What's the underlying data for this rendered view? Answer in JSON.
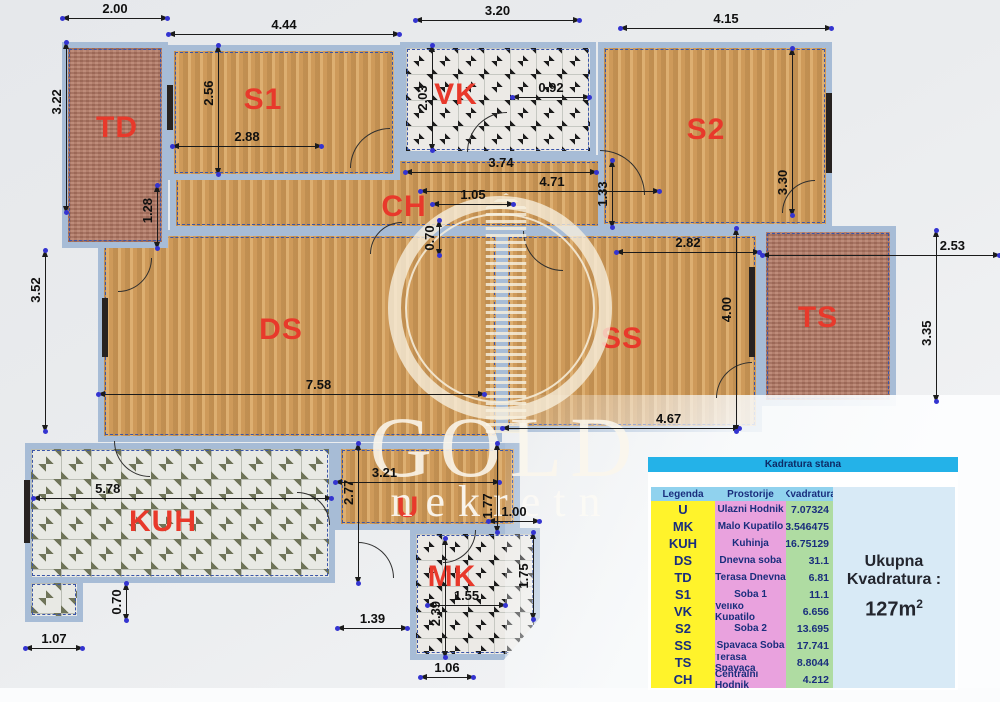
{
  "watermark": {
    "line1": "GOLD",
    "line2": "nekretn"
  },
  "plan": {
    "colors": {
      "wall": "#a7bcd6",
      "dashed_line": "#3a55a8",
      "room_label": "#e8392b",
      "dim_dot": "#3434d0",
      "dim_text": "#101010"
    },
    "rooms": [
      {
        "id": "ch",
        "label": "CH",
        "x": 170,
        "y": 155,
        "w": 442,
        "h": 77,
        "tex": "wood",
        "lx": 404,
        "ly": 207
      },
      {
        "id": "s1",
        "label": "S1",
        "x": 168,
        "y": 45,
        "w": 232,
        "h": 135,
        "tex": "wood",
        "lx": 263,
        "ly": 100
      },
      {
        "id": "vk",
        "label": "VK",
        "x": 400,
        "y": 42,
        "w": 196,
        "h": 115,
        "tex": "tileb",
        "lx": 456,
        "ly": 95
      },
      {
        "id": "s2",
        "label": "S2",
        "x": 598,
        "y": 42,
        "w": 234,
        "h": 188,
        "tex": "wood",
        "lx": 706,
        "ly": 130
      },
      {
        "id": "ds",
        "label": "DS",
        "x": 98,
        "y": 230,
        "w": 404,
        "h": 212,
        "tex": "wood",
        "lx": 281,
        "ly": 330
      },
      {
        "id": "ss",
        "label": "SS",
        "x": 502,
        "y": 230,
        "w": 260,
        "h": 202,
        "tex": "wood",
        "lx": 622,
        "ly": 339
      },
      {
        "id": "ts",
        "label": "TS",
        "x": 760,
        "y": 226,
        "w": 136,
        "h": 180,
        "tex": "terra",
        "lx": 818,
        "ly": 318
      },
      {
        "id": "td",
        "label": "TD",
        "x": 62,
        "y": 42,
        "w": 106,
        "h": 206,
        "tex": "terra",
        "lx": 117,
        "ly": 128
      },
      {
        "id": "kuh",
        "label": "KUH",
        "x": 25,
        "y": 443,
        "w": 310,
        "h": 140,
        "tex": "tileo",
        "lx": 163,
        "ly": 522
      },
      {
        "id": "kuh2",
        "label": "",
        "x": 25,
        "y": 577,
        "w": 58,
        "h": 45,
        "tex": "tileo",
        "lx": 0,
        "ly": 0
      },
      {
        "id": "u",
        "label": "U",
        "x": 335,
        "y": 443,
        "w": 185,
        "h": 87,
        "tex": "wood",
        "lx": 408,
        "ly": 508
      },
      {
        "id": "mk",
        "label": "MK",
        "x": 410,
        "y": 528,
        "w": 130,
        "h": 132,
        "tex": "tileb",
        "lx": 452,
        "ly": 577
      }
    ],
    "dimensions": [
      {
        "t": "2.00",
        "o": "h",
        "x": 62,
        "y": 18,
        "l": 106
      },
      {
        "t": "4.44",
        "o": "h",
        "x": 168,
        "y": 34,
        "l": 232
      },
      {
        "t": "3.20",
        "o": "h",
        "x": 415,
        "y": 20,
        "l": 165
      },
      {
        "t": "4.15",
        "o": "h",
        "x": 620,
        "y": 28,
        "l": 212
      },
      {
        "t": "2.88",
        "o": "h",
        "x": 172,
        "y": 146,
        "l": 150
      },
      {
        "t": "0.92",
        "o": "h",
        "x": 512,
        "y": 97,
        "l": 78
      },
      {
        "t": "3.74",
        "o": "h",
        "x": 405,
        "y": 172,
        "l": 192
      },
      {
        "t": "4.71",
        "o": "h",
        "x": 420,
        "y": 191,
        "l": 240,
        "lp": 0.55
      },
      {
        "t": "1.05",
        "o": "h",
        "x": 432,
        "y": 204,
        "l": 82
      },
      {
        "t": "2.82",
        "o": "h",
        "x": 616,
        "y": 252,
        "l": 144
      },
      {
        "t": "2.53",
        "o": "h",
        "x": 762,
        "y": 255,
        "l": 238,
        "lp": 0.8
      },
      {
        "t": "7.58",
        "o": "h",
        "x": 98,
        "y": 394,
        "l": 387,
        "lp": 0.57
      },
      {
        "t": "4.67",
        "o": "h",
        "x": 502,
        "y": 428,
        "l": 238,
        "lp": 0.7
      },
      {
        "t": "5.78",
        "o": "h",
        "x": 33,
        "y": 498,
        "l": 299,
        "lp": 0.25
      },
      {
        "t": "1.07",
        "o": "h",
        "x": 25,
        "y": 648,
        "l": 58
      },
      {
        "t": "3.21",
        "o": "h",
        "x": 335,
        "y": 482,
        "l": 165,
        "lp": 0.3
      },
      {
        "t": "1.00",
        "o": "h",
        "x": 488,
        "y": 521,
        "l": 52
      },
      {
        "t": "1.55",
        "o": "h",
        "x": 427,
        "y": 605,
        "l": 79
      },
      {
        "t": "1.39",
        "o": "h",
        "x": 337,
        "y": 628,
        "l": 71
      },
      {
        "t": "1.06",
        "o": "h",
        "x": 420,
        "y": 677,
        "l": 54
      },
      {
        "t": "3.22",
        "o": "v",
        "x": 66,
        "y": 42,
        "l": 171,
        "lp": 0.65
      },
      {
        "t": "3.52",
        "o": "v",
        "x": 45,
        "y": 250,
        "l": 182,
        "lp": 0.78
      },
      {
        "t": "2.56",
        "o": "v",
        "x": 218,
        "y": 45,
        "l": 130,
        "lp": 0.63
      },
      {
        "t": "1.28",
        "o": "v",
        "x": 157,
        "y": 185,
        "l": 64,
        "lp": 0.6
      },
      {
        "t": "2.03",
        "o": "v",
        "x": 432,
        "y": 45,
        "l": 106
      },
      {
        "t": "1.33",
        "o": "v",
        "x": 612,
        "y": 160,
        "l": 68
      },
      {
        "t": "0.70",
        "o": "v",
        "x": 439,
        "y": 220,
        "l": 36
      },
      {
        "t": "3.30",
        "o": "v",
        "x": 792,
        "y": 48,
        "l": 168,
        "lp": 0.2
      },
      {
        "t": "4.00",
        "o": "v",
        "x": 736,
        "y": 228,
        "l": 204,
        "lp": 0.6
      },
      {
        "t": "3.35",
        "o": "v",
        "x": 936,
        "y": 230,
        "l": 172,
        "lp": 0.4
      },
      {
        "t": "2.77",
        "o": "v",
        "x": 358,
        "y": 443,
        "l": 141,
        "lp": 0.65
      },
      {
        "t": "1.77",
        "o": "v",
        "x": 497,
        "y": 443,
        "l": 90,
        "lp": 0.3
      },
      {
        "t": "1.75",
        "o": "v",
        "x": 533,
        "y": 532,
        "l": 88
      },
      {
        "t": "2.39",
        "o": "v",
        "x": 445,
        "y": 538,
        "l": 120,
        "lp": 0.37
      },
      {
        "t": "0.70",
        "o": "v",
        "x": 126,
        "y": 583,
        "l": 38
      }
    ],
    "doors": [
      {
        "x": 350,
        "y": 128,
        "r": 40,
        "rot": 0
      },
      {
        "x": 118,
        "y": 258,
        "r": 34,
        "rot": 180
      },
      {
        "x": 370,
        "y": 222,
        "r": 32,
        "rot": 0
      },
      {
        "x": 467,
        "y": 112,
        "r": 40,
        "rot": 0
      },
      {
        "x": 600,
        "y": 150,
        "r": 45,
        "rot": 90
      },
      {
        "x": 782,
        "y": 180,
        "r": 33,
        "rot": 0
      },
      {
        "x": 716,
        "y": 362,
        "r": 36,
        "rot": 0
      },
      {
        "x": 114,
        "y": 441,
        "r": 36,
        "rot": 270
      },
      {
        "x": 297,
        "y": 492,
        "r": 33,
        "rot": 90
      },
      {
        "x": 358,
        "y": 542,
        "r": 36,
        "rot": 90
      },
      {
        "x": 443,
        "y": 530,
        "r": 33,
        "rot": 180
      },
      {
        "x": 523,
        "y": 231,
        "r": 40,
        "rot": 270
      }
    ],
    "fixtures": [
      {
        "x": 167,
        "y": 85,
        "w": 6,
        "h": 45
      },
      {
        "x": 102,
        "y": 298,
        "w": 6,
        "h": 59
      },
      {
        "x": 826,
        "y": 93,
        "w": 6,
        "h": 80
      },
      {
        "x": 749,
        "y": 267,
        "w": 6,
        "h": 90
      },
      {
        "x": 24,
        "y": 480,
        "w": 6,
        "h": 63
      }
    ]
  },
  "legend": {
    "title": "Kadratura stana",
    "columns": [
      "Legenda",
      "Prostorije",
      "Kvadratura"
    ],
    "rows": [
      [
        "U",
        "Ulazni Hodnik",
        "7.07324"
      ],
      [
        "MK",
        "Malo Kupatilo",
        "3.546475"
      ],
      [
        "KUH",
        "Kuhinja",
        "16.75129"
      ],
      [
        "DS",
        "Dnevna soba",
        "31.1"
      ],
      [
        "TD",
        "Terasa Dnevna",
        "6.81"
      ],
      [
        "S1",
        "Soba 1",
        "11.1"
      ],
      [
        "VK",
        "Veliko Kupatilo",
        "6.656"
      ],
      [
        "S2",
        "Soba 2",
        "13.695"
      ],
      [
        "SS",
        "Spavaca Soba",
        "17.741"
      ],
      [
        "TS",
        "Terasa Spavaca",
        "8.8044"
      ],
      [
        "CH",
        "Centralni Hodnik",
        "4.212"
      ]
    ],
    "total": {
      "line1": "Ukupna",
      "line2": "Kvadratura :",
      "value": "127m",
      "sup": "2"
    },
    "colors": {
      "title_bg": "#24b2e8",
      "header_bg": "#90d2ee",
      "legenda_bg": "#fff32b",
      "prostorije_bg": "#e9a2de",
      "kvadratura_bg": "#afdca2",
      "total_bg": "#d8eaf6",
      "text": "#1a2e7d"
    }
  }
}
